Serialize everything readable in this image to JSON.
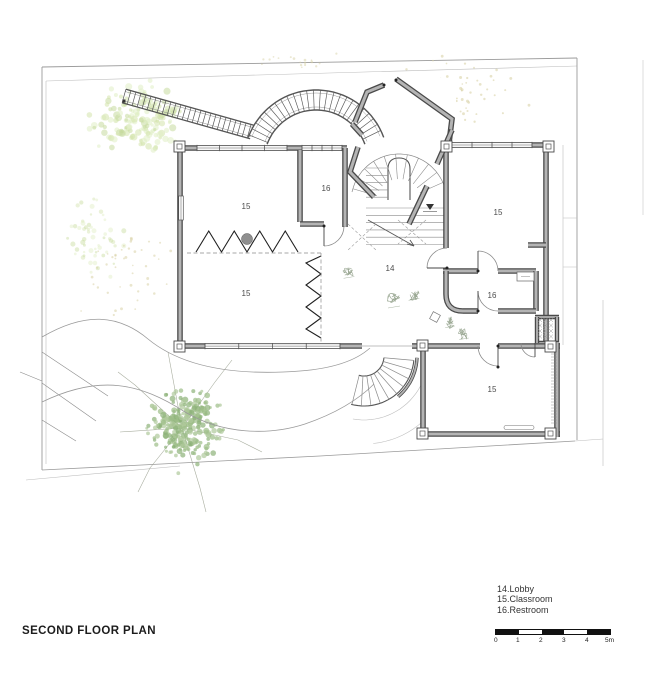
{
  "title": "SECOND FLOOR PLAN",
  "legend": {
    "items": [
      {
        "number": "14",
        "name": "Lobby",
        "label": "14.Lobby"
      },
      {
        "number": "15",
        "name": "Classroom",
        "label": "15.Classroom"
      },
      {
        "number": "16",
        "name": "Restroom",
        "label": "16.Restroom"
      }
    ]
  },
  "scale_bar": {
    "labels": [
      "0",
      "1",
      "2",
      "3",
      "4",
      "5m"
    ],
    "units_per_segment": 1
  },
  "rooms": [
    {
      "number": "15",
      "name": "Classroom",
      "position": "top-left"
    },
    {
      "number": "16",
      "name": "Restroom",
      "position": "top-center"
    },
    {
      "number": "15",
      "name": "Classroom",
      "position": "bottom-left"
    },
    {
      "number": "14",
      "name": "Lobby",
      "position": "center"
    },
    {
      "number": "15",
      "name": "Classroom",
      "position": "top-right"
    },
    {
      "number": "16",
      "name": "Restroom",
      "position": "right"
    },
    {
      "number": "15",
      "name": "Classroom",
      "position": "bottom"
    }
  ],
  "colors": {
    "wall_edge": "#4a4a4a",
    "wall_fill": "#b4b4b4",
    "line_dark": "#555555",
    "line_mid": "#8a8a8a",
    "line_light": "#bdbdbd",
    "boundary": "#9a9a9a",
    "zigzag": "#1f1f1f",
    "dots_tan": "#d8d2a6",
    "tree_light": [
      "#d3e3ac",
      "#c7db9e",
      "#e0eec4"
    ],
    "tree_dark": [
      "#9cbd87",
      "#8db279",
      "#afc99b"
    ],
    "figure": "#93a28c",
    "text": "#2a2a2a"
  }
}
